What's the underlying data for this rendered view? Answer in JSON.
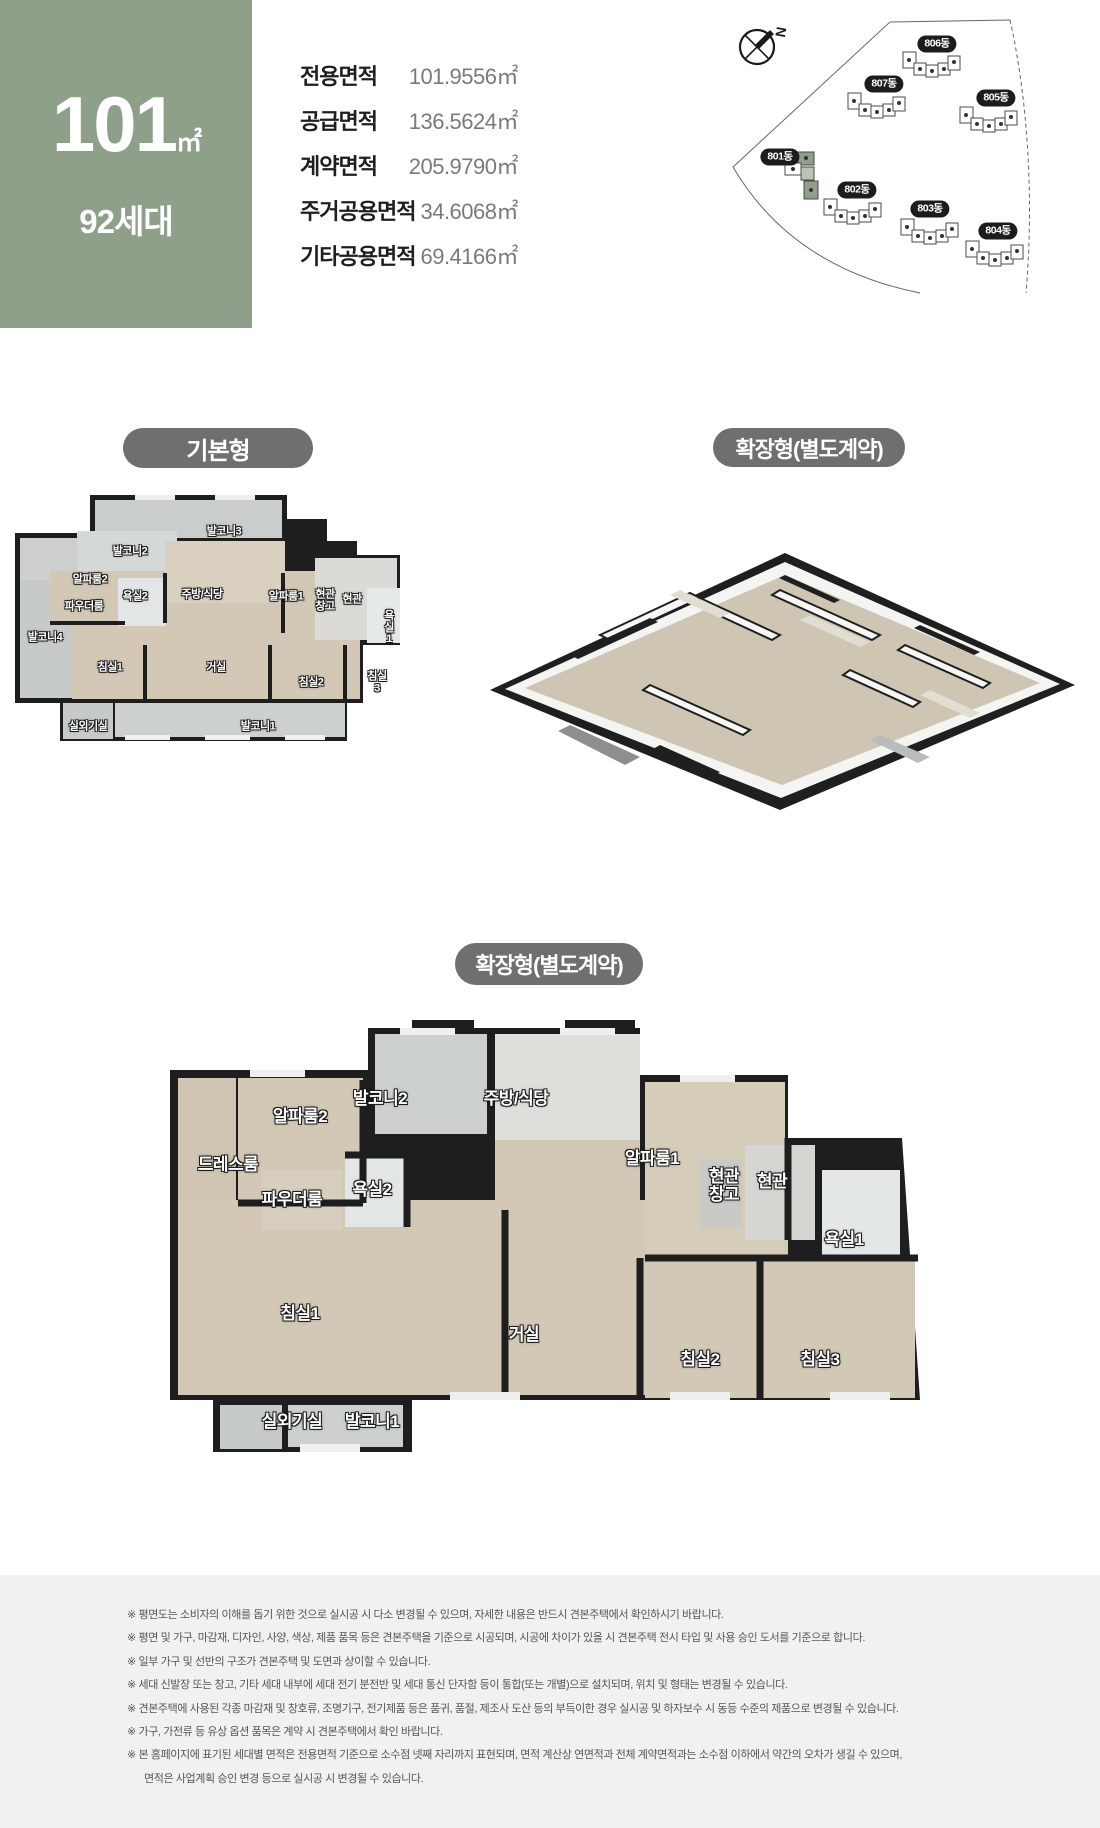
{
  "header": {
    "area_box": {
      "value": "101",
      "unit": "㎡",
      "households": "92세대"
    },
    "table": {
      "rows": [
        {
          "label": "전용면적",
          "value": "101.9556㎡"
        },
        {
          "label": "공급면적",
          "value": "136.5624㎡"
        },
        {
          "label": "계약면적",
          "value": "205.9790㎡"
        },
        {
          "label": "주거공용면적",
          "value": "34.6068㎡"
        },
        {
          "label": "기타공용면적",
          "value": "69.4166㎡"
        }
      ]
    },
    "site_plan": {
      "compass_label": "N",
      "buildings": [
        {
          "name": "806동",
          "x": 322,
          "y": 39,
          "highlight": false
        },
        {
          "name": "807동",
          "x": 269,
          "y": 79,
          "highlight": false
        },
        {
          "name": "805동",
          "x": 381,
          "y": 93,
          "highlight": false
        },
        {
          "name": "801동",
          "x": 165,
          "y": 152,
          "highlight": true
        },
        {
          "name": "802동",
          "x": 242,
          "y": 185,
          "highlight": false
        },
        {
          "name": "803동",
          "x": 315,
          "y": 204,
          "highlight": false
        },
        {
          "name": "804동",
          "x": 383,
          "y": 226,
          "highlight": false
        }
      ]
    }
  },
  "plans": {
    "basic": {
      "tag": "기본형",
      "rooms": [
        {
          "label": "발코니3",
          "x": 209,
          "y": 49
        },
        {
          "label": "발코니2",
          "x": 115,
          "y": 69
        },
        {
          "label": "알파룸2",
          "x": 75,
          "y": 97
        },
        {
          "label": "욕실2",
          "x": 120,
          "y": 114
        },
        {
          "label": "주방/식당",
          "x": 187,
          "y": 112
        },
        {
          "label": "알파룸1",
          "x": 271,
          "y": 114
        },
        {
          "label": "현관\n창고",
          "x": 310,
          "y": 118
        },
        {
          "label": "현관",
          "x": 337,
          "y": 117
        },
        {
          "label": "파우더룸",
          "x": 69,
          "y": 124
        },
        {
          "label": "발코니4",
          "x": 30,
          "y": 155
        },
        {
          "label": "욕실1",
          "x": 374,
          "y": 145
        },
        {
          "label": "침실1",
          "x": 95,
          "y": 185
        },
        {
          "label": "거실",
          "x": 201,
          "y": 185
        },
        {
          "label": "침실2",
          "x": 296,
          "y": 200
        },
        {
          "label": "침실3",
          "x": 362,
          "y": 200
        },
        {
          "label": "실외기실",
          "x": 73,
          "y": 244
        },
        {
          "label": "발코니1",
          "x": 243,
          "y": 244
        }
      ]
    },
    "extended_3d": {
      "tag": "확장형(별도계약)"
    },
    "extended": {
      "tag": "확장형(별도계약)",
      "rooms": [
        {
          "label": "드레스룸",
          "x": 78,
          "y": 145
        },
        {
          "label": "알파룸2",
          "x": 150,
          "y": 97
        },
        {
          "label": "발코니2",
          "x": 230,
          "y": 79
        },
        {
          "label": "주방/식당",
          "x": 366,
          "y": 79
        },
        {
          "label": "알파룸1",
          "x": 502,
          "y": 139
        },
        {
          "label": "현관\n창고",
          "x": 574,
          "y": 166
        },
        {
          "label": "현관",
          "x": 622,
          "y": 162
        },
        {
          "label": "욕실2",
          "x": 222,
          "y": 170
        },
        {
          "label": "파우더룸",
          "x": 142,
          "y": 180
        },
        {
          "label": "욕실1",
          "x": 694,
          "y": 220
        },
        {
          "label": "침실1",
          "x": 150,
          "y": 294
        },
        {
          "label": "거실",
          "x": 374,
          "y": 315
        },
        {
          "label": "침실2",
          "x": 550,
          "y": 340
        },
        {
          "label": "침실3",
          "x": 670,
          "y": 340
        },
        {
          "label": "실외기실",
          "x": 142,
          "y": 402
        },
        {
          "label": "발코니1",
          "x": 222,
          "y": 402
        }
      ]
    }
  },
  "disclaimer": {
    "lines": [
      "※ 평면도는 소비자의 이해를 돕기 위한 것으로 실시공 시 다소 변경될 수 있으며, 자세한 내용은 반드시 견본주택에서 확인하시기 바랍니다.",
      "※ 평면 및 가구, 마감재, 디자인, 사양, 색상, 제품 품목 등은 견본주택을 기준으로 시공되며, 시공에 차이가 있을 시 견본주택 전시 타입 및 사용 승인 도서를 기준으로 합니다.",
      "※ 일부 가구 및 선반의 구조가 견본주택 및 도면과 상이할 수 있습니다.",
      "※ 세대 신발장 또는 창고, 기타 세대 내부에 세대 전기 분전반 및 세대 통신 단자함 등이 통합(또는 개별)으로 설치되며, 위치 및 형태는 변경될 수 있습니다.",
      "※ 견본주택에 사용된 각종 마감재 및 창호류, 조명기구, 전기제품 등은 품귀, 품절, 제조사 도산 등의 부득이한 경우 실시공 및 하자보수 시 동등 수준의 제품으로 변경될 수 있습니다.",
      "※ 가구, 가전류 등 유상 옵션 품목은 계약 시 견본주택에서 확인 바랍니다.",
      "※ 본 홈페이지에 표기된 세대별 면적은 전용면적 기준으로 소수점 넷째 자리까지 표현되며, 면적 계산상 연면적과 전체 계약면적과는 소수점 이하에서 약간의 오차가 생길 수 있으며,",
      "면적은 사업계획 승인 변경 등으로 실시공 시 변경될 수 있습니다."
    ]
  },
  "colors": {
    "accent_green": "#8fa08a",
    "pill_gray": "#6f6f6f",
    "wall_dark": "#1e1e1e",
    "floor_wood": "#d3c8b5",
    "balcony_gray": "#ccd0ce",
    "disclaimer_bg": "#f1f1f2"
  }
}
